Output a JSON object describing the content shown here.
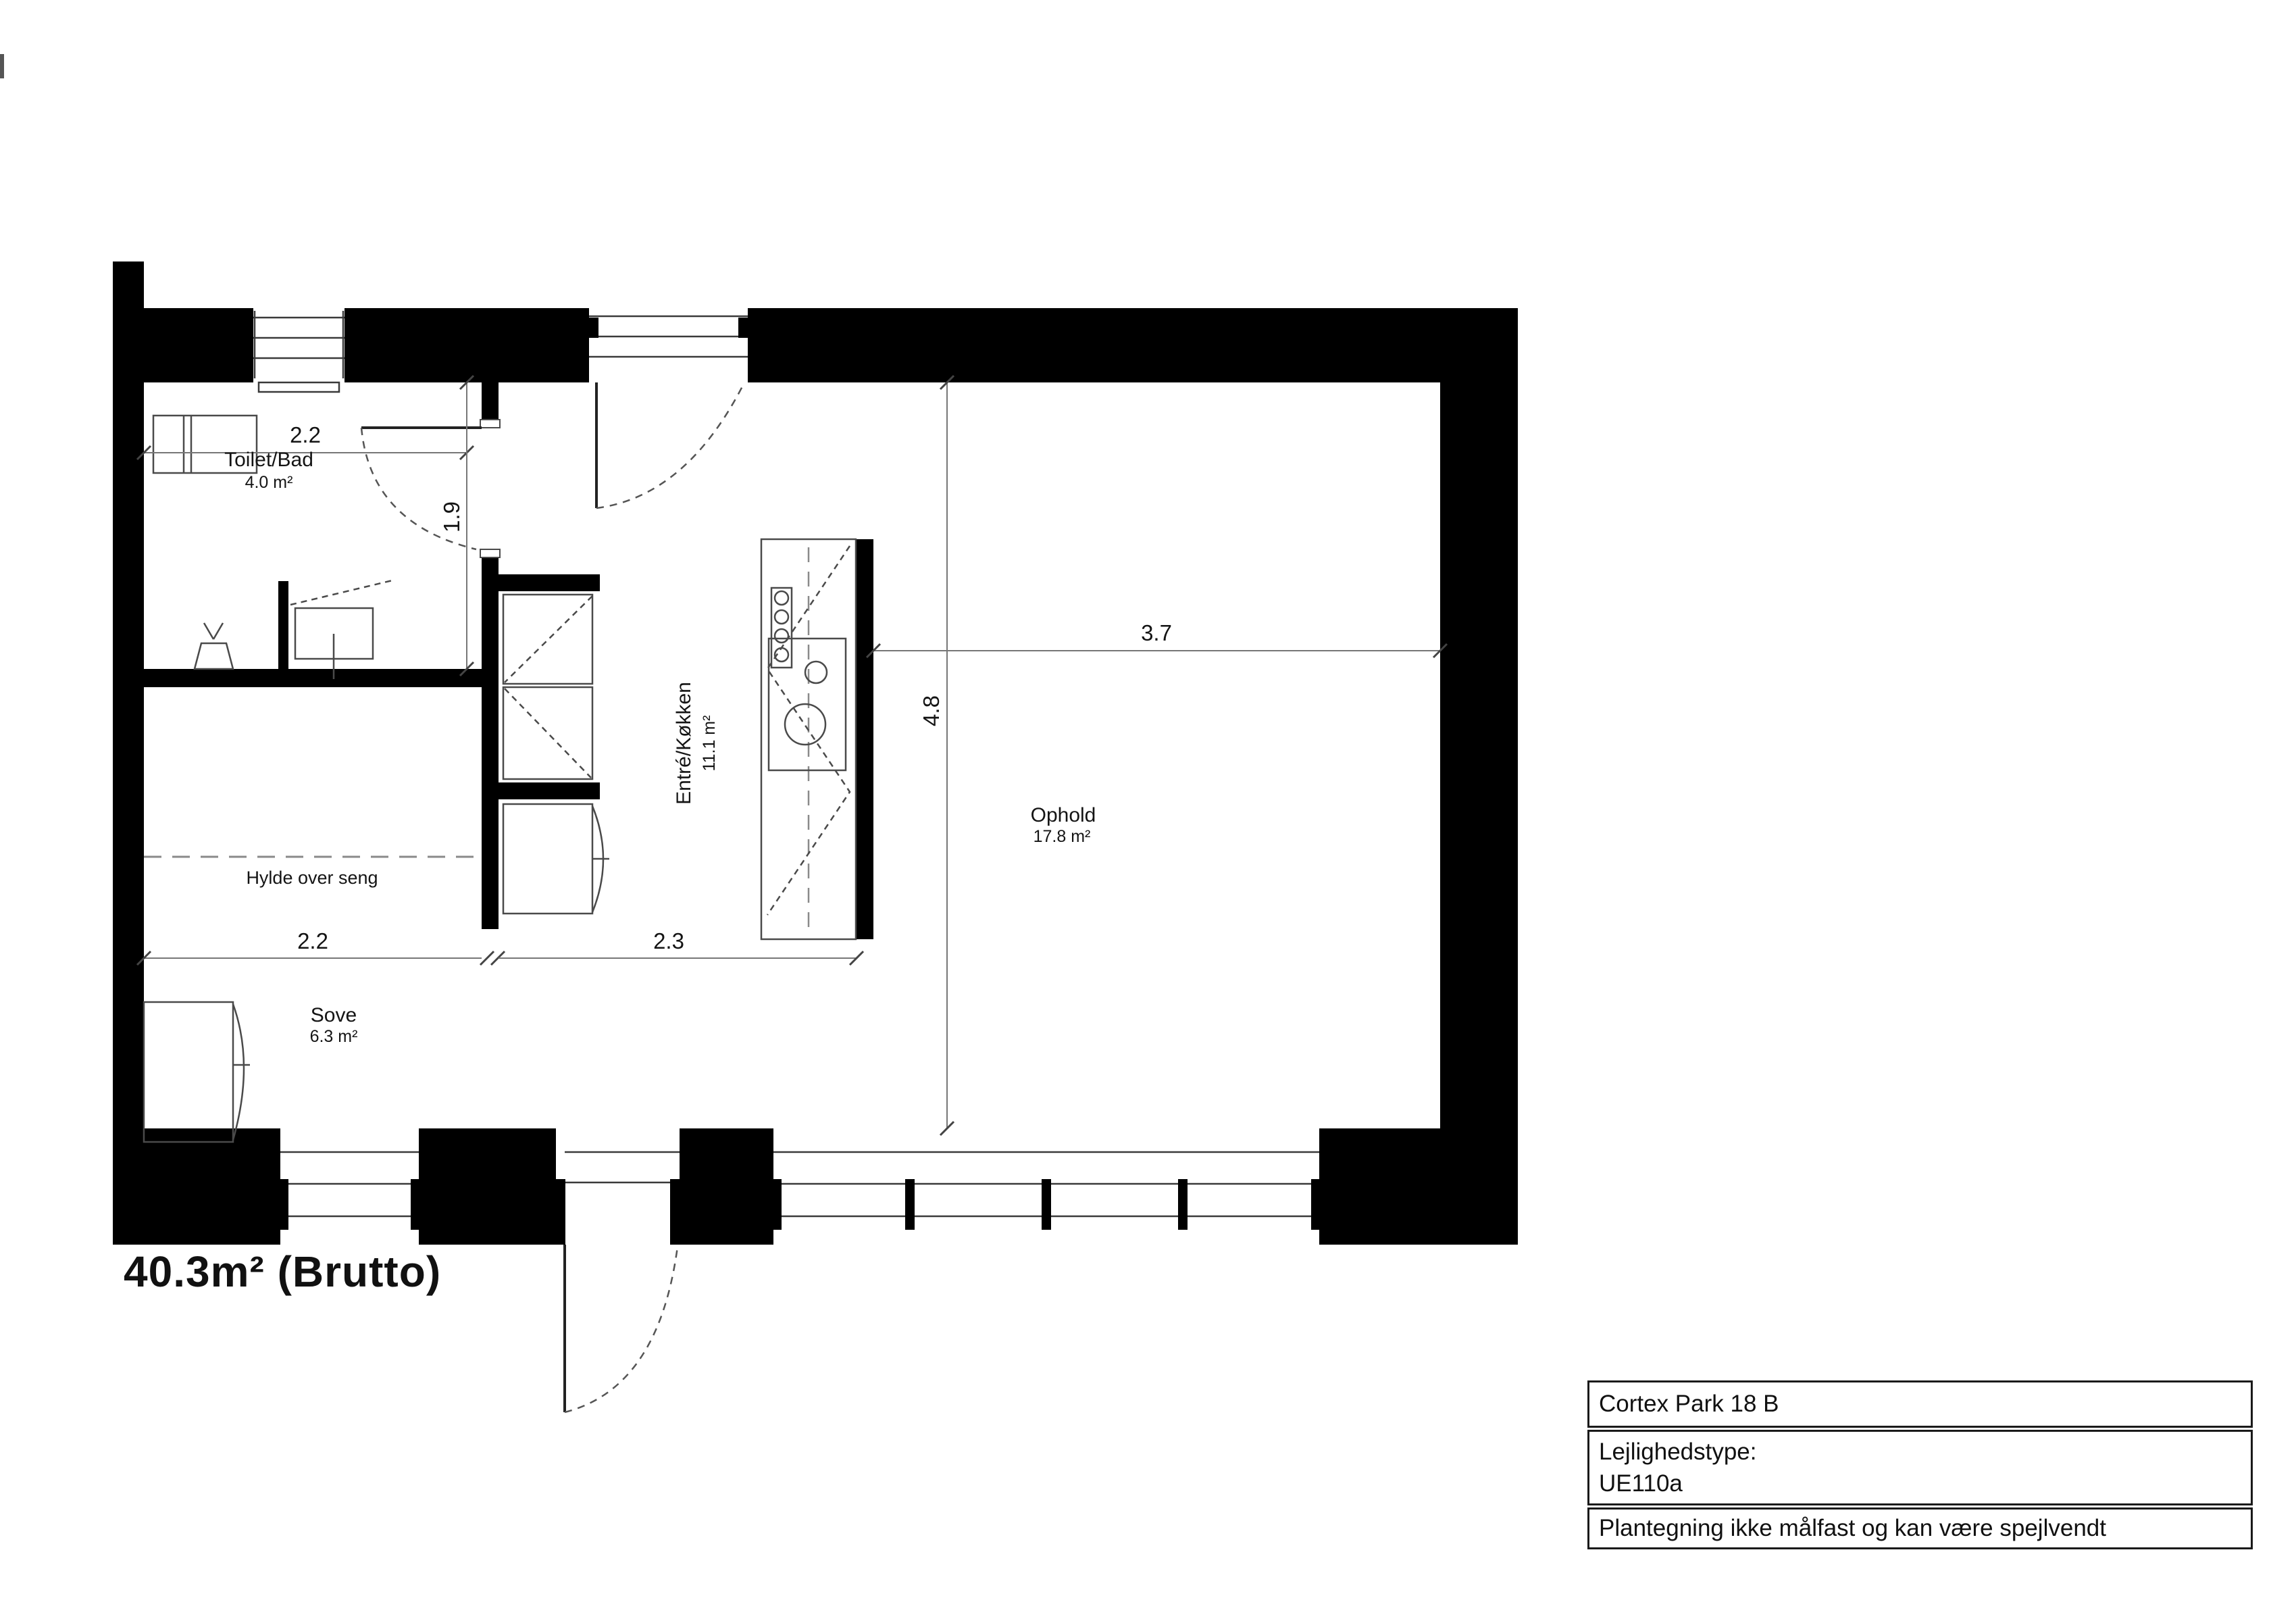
{
  "plan": {
    "gross_area_label": "40.3m² (Brutto)",
    "rooms": [
      {
        "name": "Toilet/Bad",
        "area": "4.0 m²"
      },
      {
        "name": "Entré/Køkken",
        "area": "11.1 m²"
      },
      {
        "name": "Ophold",
        "area": "17.8 m²"
      },
      {
        "name": "Sove",
        "area": "6.3 m²"
      }
    ],
    "dimensions": {
      "toilet_width": "2.2",
      "toilet_depth": "1.9",
      "living_width": "3.7",
      "apartment_depth": "4.8",
      "sove_width": "2.2",
      "entre_width": "2.3"
    },
    "annotations": {
      "shelf_note": "Hylde over seng"
    }
  },
  "title_block": {
    "address": "Cortex Park 18 B",
    "type_label": "Lejlighedstype:",
    "type_value": "UE110a",
    "disclaimer": "Plantegning ikke målfast og kan være spejlvendt"
  },
  "colors": {
    "wall": "#000000",
    "thin_line": "#4a4a4a",
    "dim_line": "#777777",
    "background": "#ffffff"
  }
}
